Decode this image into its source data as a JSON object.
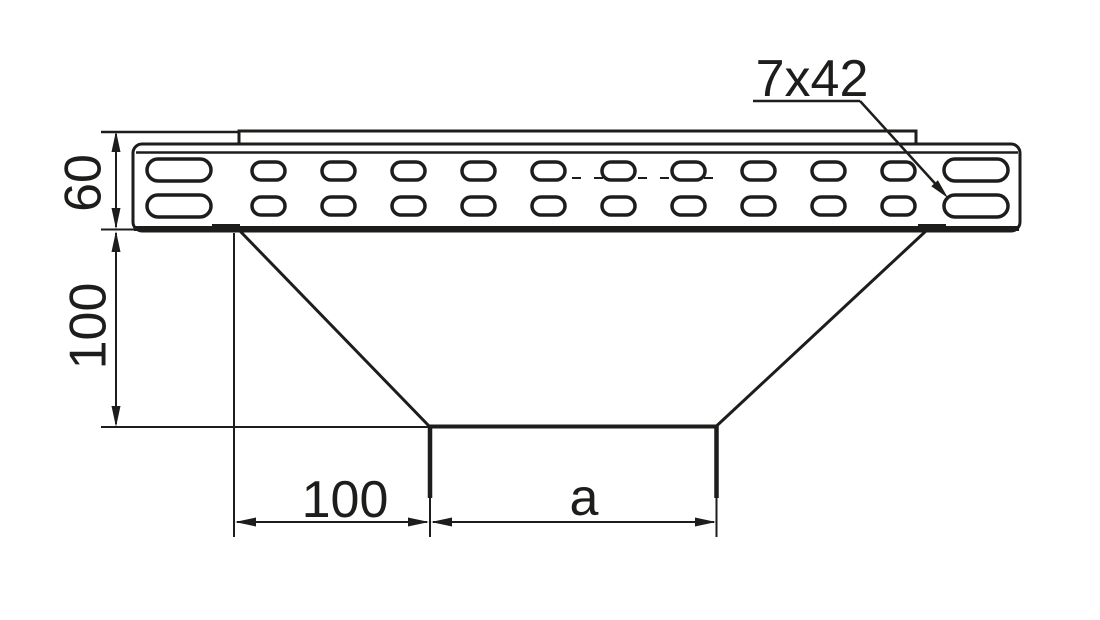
{
  "drawing": {
    "dimensions": [
      {
        "id": "rail-height",
        "label": "60",
        "orientation": "vertical"
      },
      {
        "id": "branch-depth",
        "label": "100",
        "orientation": "vertical"
      },
      {
        "id": "left-offset",
        "label": "100",
        "orientation": "horizontal"
      },
      {
        "id": "branch-width",
        "label": "a",
        "orientation": "horizontal"
      }
    ],
    "callouts": [
      {
        "id": "slot-size",
        "label": "7x42"
      }
    ],
    "colors": {
      "line": "#1d1d1b",
      "background": "#ffffff"
    }
  }
}
